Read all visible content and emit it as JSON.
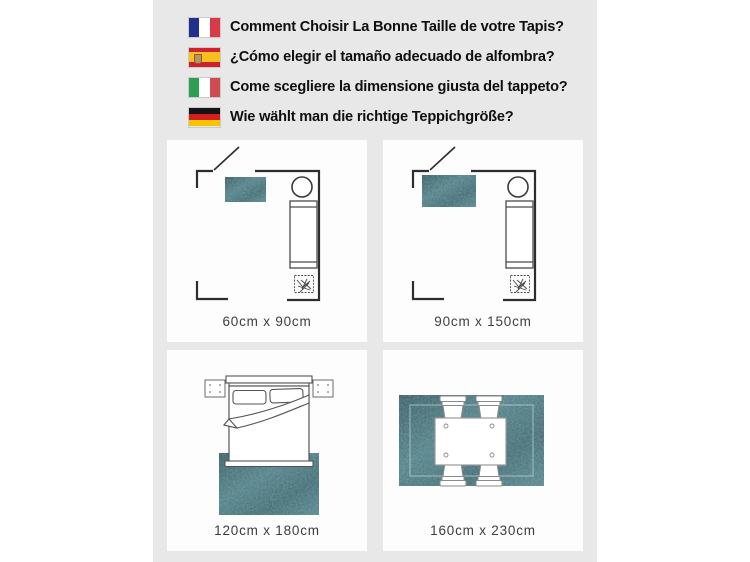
{
  "header": {
    "items": [
      {
        "flag": "france-flag",
        "text": "Comment Choisir La Bonne Taille de votre Tapis?"
      },
      {
        "flag": "spain-flag",
        "text": "¿Cómo elegir el tamaño adecuado de alfombra?"
      },
      {
        "flag": "italy-flag",
        "text": "Come scegliere la dimensione giusta del tappeto?"
      },
      {
        "flag": "germany-flag",
        "text": "Wie wählt man die richtige Teppichgröße?"
      }
    ]
  },
  "panels": [
    {
      "id": "bedroom-small-rug",
      "label": "60cm x 90cm",
      "rug": {
        "x": 58,
        "y": 37,
        "w": 41,
        "h": 25
      }
    },
    {
      "id": "bedroom-medium-rug",
      "label": "90cm x 150cm",
      "rug": {
        "x": 39,
        "y": 35,
        "w": 54,
        "h": 32
      }
    },
    {
      "id": "bed-rug",
      "label": "120cm x 180cm"
    },
    {
      "id": "dining-rug",
      "label": "160cm x 230cm"
    }
  ],
  "colors": {
    "stage_bg": "#e8e8e8",
    "rug_teal": "#426f78",
    "wall_line": "#2d2d2d",
    "furniture_line": "#4a4a4a",
    "label_text": "#3d3d3d"
  }
}
